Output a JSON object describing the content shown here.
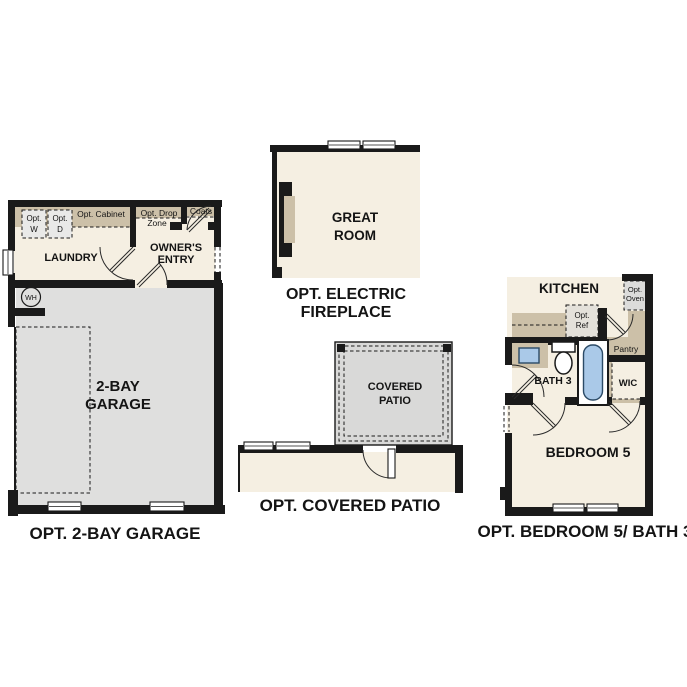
{
  "page": {
    "background": "#ffffff"
  },
  "colors": {
    "wall": "#1a1a1a",
    "floor_cream": "#f5efe2",
    "cabinet_tan": "#ccc0a8",
    "garage_gray": "#dfdfde",
    "patio_gray": "#d9d9d8",
    "fixture_blue": "#aac9e8"
  },
  "plans": {
    "garage": {
      "caption": "OPT. 2-BAY GARAGE",
      "rooms": {
        "laundry": "LAUNDRY",
        "owners_entry_line1": "OWNER'S",
        "owners_entry_line2": "ENTRY",
        "garage_line1": "2-BAY",
        "garage_line2": "GARAGE"
      },
      "features": {
        "opt_w_line1": "Opt.",
        "opt_w_line2": "W",
        "opt_d_line1": "Opt.",
        "opt_d_line2": "D",
        "opt_cabinet": "Opt. Cabinet",
        "opt_drop_line1": "Opt. Drop",
        "opt_drop_line2": "Zone",
        "coats": "Coats",
        "water_heater": "WH"
      }
    },
    "fireplace": {
      "caption_line1": "OPT. ELECTRIC",
      "caption_line2": "FIREPLACE",
      "rooms": {
        "great_room_line1": "GREAT",
        "great_room_line2": "ROOM"
      }
    },
    "patio": {
      "caption": "OPT. COVERED PATIO",
      "rooms": {
        "covered_patio_line1": "COVERED",
        "covered_patio_line2": "PATIO"
      }
    },
    "bedroom5": {
      "caption": "OPT. BEDROOM 5/ BATH 3",
      "rooms": {
        "kitchen": "KITCHEN",
        "pantry": "Pantry",
        "bath3": "BATH 3",
        "wic": "WIC",
        "bedroom5": "BEDROOM 5"
      },
      "features": {
        "opt_ref_line1": "Opt.",
        "opt_ref_line2": "Ref",
        "opt_oven_line1": "Opt.",
        "opt_oven_line2": "Oven"
      }
    }
  }
}
